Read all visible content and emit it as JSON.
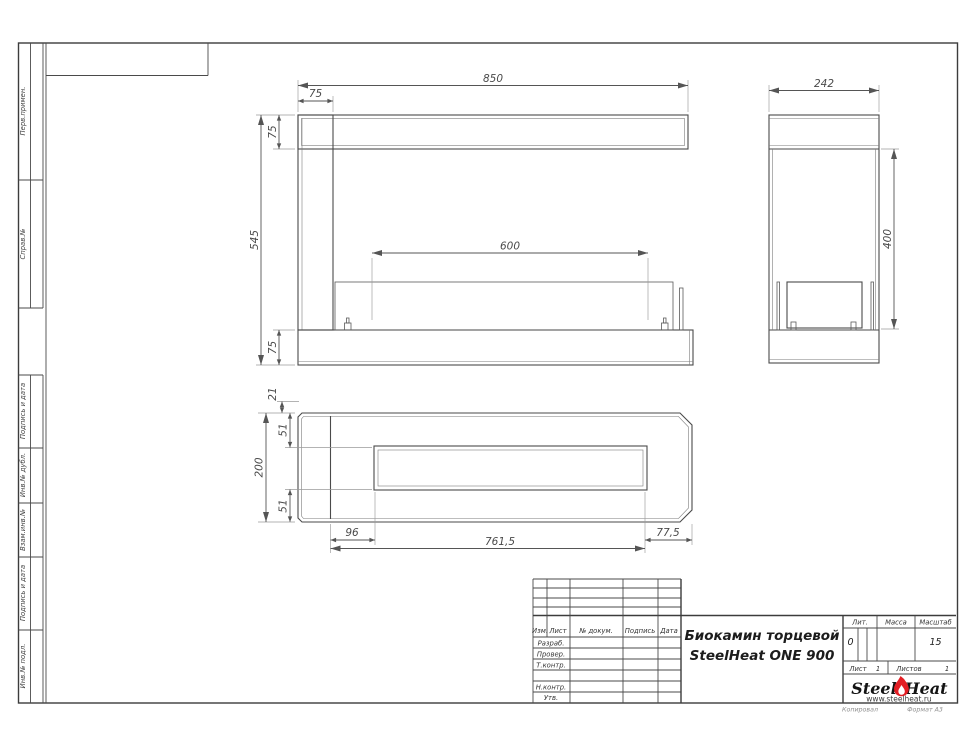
{
  "drawing": {
    "stamp_column": {
      "boxes": [
        {
          "label": "Перв.примен."
        },
        {
          "label": "Справ.№"
        },
        {
          "label": "Подпись и дата"
        },
        {
          "label": "Инв.№ дубл."
        },
        {
          "label": "Взам.инв.№"
        },
        {
          "label": "Подпись и дата"
        },
        {
          "label": "Инв.№ подл."
        }
      ]
    },
    "views": {
      "front": {
        "dims": {
          "overall_width": "850",
          "left_inset": "75",
          "top_bar_height": "75",
          "overall_height": "545",
          "burner_length": "600",
          "base_height": "75"
        }
      },
      "side": {
        "dims": {
          "overall_depth": "242",
          "opening_height": "400"
        }
      },
      "top": {
        "dims": {
          "lip": "21",
          "front_wall": "51",
          "overall_depth": "200",
          "back_wall": "51",
          "left_offset": "96",
          "slot_length": "761,5",
          "right_offset": "77,5"
        }
      }
    }
  },
  "title_block": {
    "revision_header": {
      "izm": "Изм.",
      "list": "Лист",
      "doc": "№ докум.",
      "sign": "Подпись",
      "date": "Дата"
    },
    "approval_rows": {
      "developed": "Разраб.",
      "checked": "Провер.",
      "tcontrol": "Т.контр.",
      "ncontrol": "Н.контр.",
      "approved": "Утв."
    },
    "title_line1": "Биокамин торцевой",
    "title_line2": "SteelHeat ONE 900",
    "lit": {
      "label": "Лит.",
      "value": "0"
    },
    "mass": {
      "label": "Масса"
    },
    "scale": {
      "label": "Масштаб",
      "value": "15"
    },
    "sheet": {
      "label": "Лист",
      "value": "1"
    },
    "sheets": {
      "label": "Листов",
      "value": "1"
    },
    "logo": {
      "word1": "Steel",
      "word2": "Heat",
      "site": "www.steelheat.ru"
    },
    "footer": {
      "copied": "Копировал",
      "format": "Формат А3"
    },
    "colors": {
      "logo_red": "#e31e24",
      "site_red": "#c00000"
    }
  }
}
